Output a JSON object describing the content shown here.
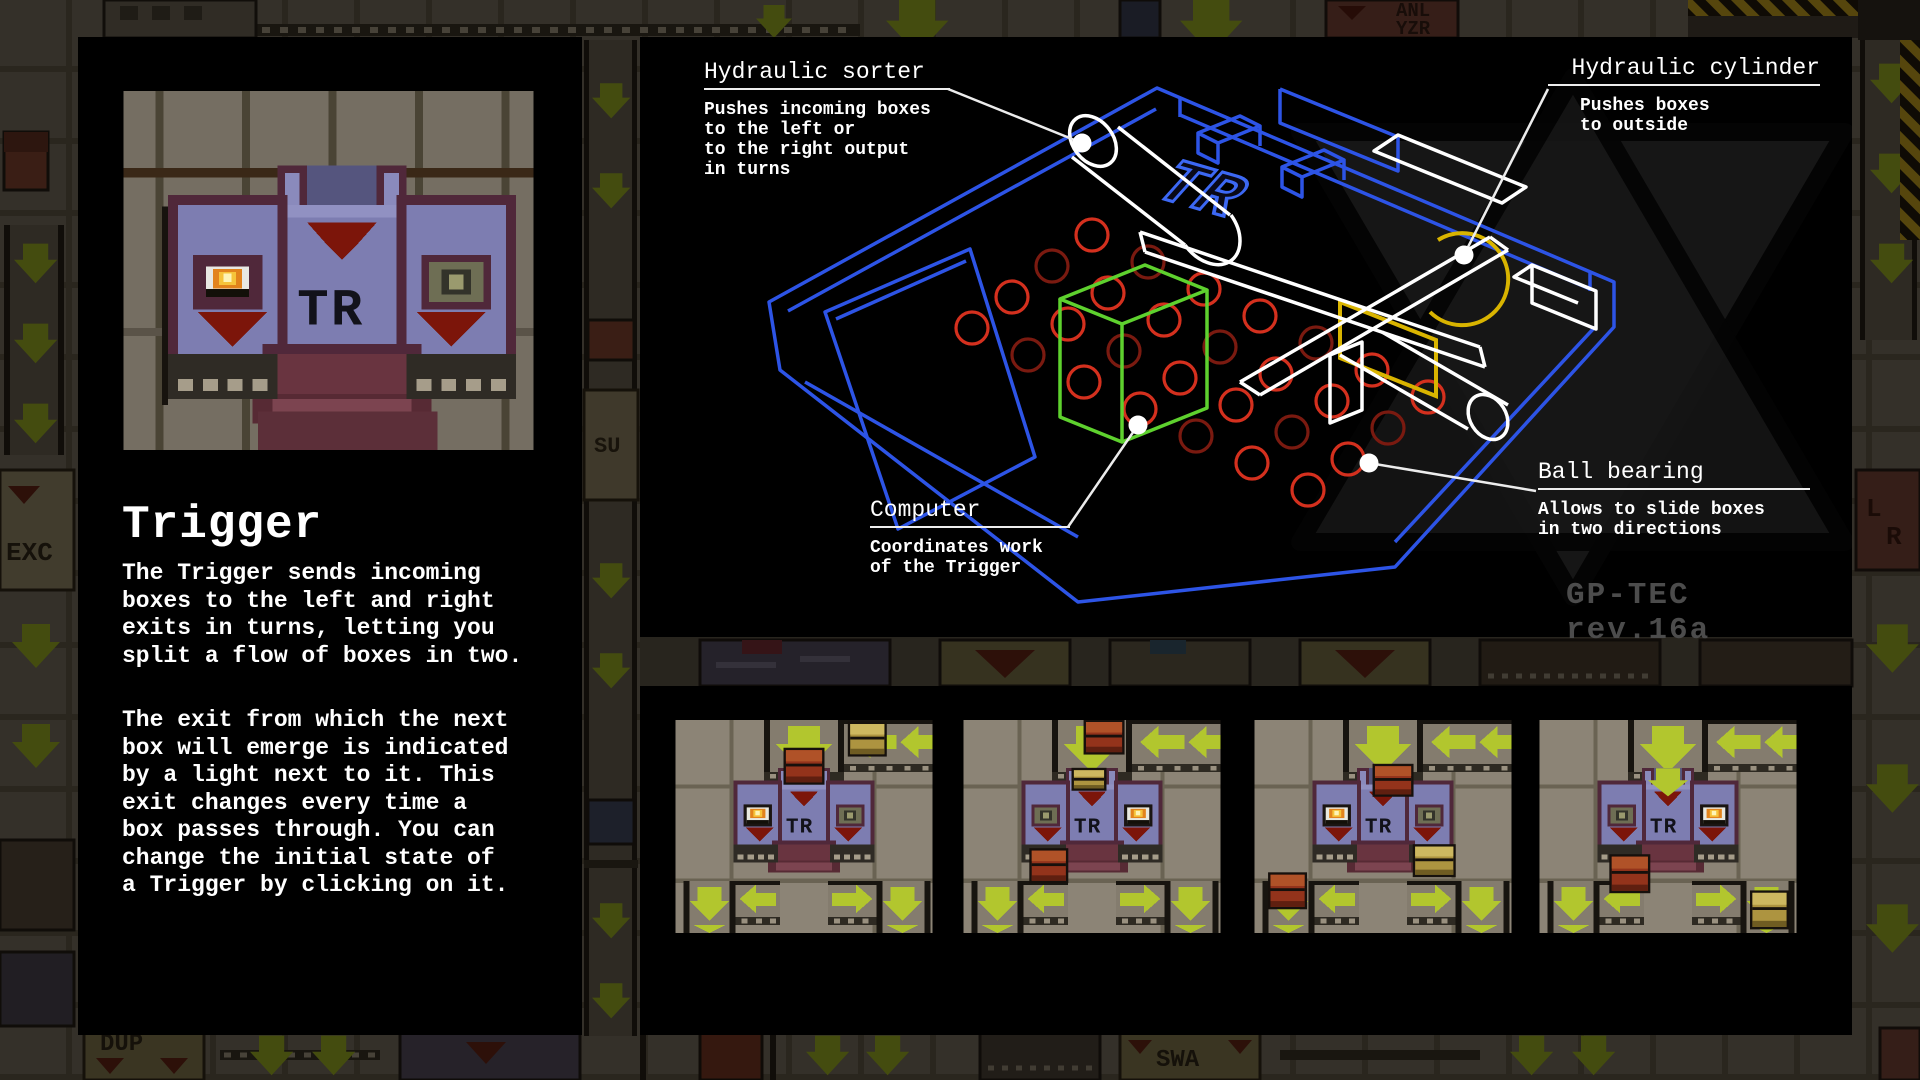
{
  "panel_left": {
    "title": "Trigger",
    "machine_label": "TR",
    "paragraph1": "The Trigger sends incoming\nboxes to the left and right\nexits in turns, letting you\nsplit a flow of boxes in two.",
    "paragraph2": "The exit from which the next\nbox will emerge is indicated\nby a light next to it. This\nexit changes every time a\nbox passes through. You can\nchange the initial state of\na Trigger by clicking on it."
  },
  "diagram": {
    "machine_emblem": "TR",
    "watermark_text": "GP-TEC rev.16a",
    "callouts": {
      "sorter": {
        "title": "Hydraulic sorter",
        "desc": "Pushes incoming boxes\nto the left or\nto the right output\nin turns"
      },
      "cylinder": {
        "title": "Hydraulic cylinder",
        "desc": "Pushes boxes\nto outside"
      },
      "computer": {
        "title": "Computer",
        "desc": "Coordinates work\nof the Trigger"
      },
      "bearing": {
        "title": "Ball bearing",
        "desc": "Allows to slide boxes\nin two directions"
      }
    },
    "colors": {
      "wireframe_blue": "#2d54e6",
      "computer_green": "#5ed12e",
      "bearing_red": "#d4301e",
      "cylinder_yellow": "#d9b400",
      "callout_white": "#ffffff"
    }
  },
  "screenshots": [
    {
      "lamp_lit": "left",
      "intake_arrow": false,
      "boxes": [
        {
          "color": "red",
          "x": 55,
          "y": 15,
          "w": 18,
          "h": 16
        },
        {
          "color": "yellow",
          "x": 87,
          "y": 2,
          "w": 17,
          "h": 15
        }
      ]
    },
    {
      "lamp_lit": "right",
      "intake_arrow": false,
      "boxes": [
        {
          "color": "yellow",
          "x": 55,
          "y": 25,
          "w": 15,
          "h": 9
        },
        {
          "color": "red",
          "x": 61,
          "y": 1,
          "w": 18,
          "h": 15
        },
        {
          "color": "red",
          "x": 34,
          "y": 65,
          "w": 17,
          "h": 15
        }
      ]
    },
    {
      "lamp_lit": "left",
      "intake_arrow": false,
      "boxes": [
        {
          "color": "red",
          "x": 60,
          "y": 23,
          "w": 18,
          "h": 14
        },
        {
          "color": "yellow",
          "x": 80,
          "y": 63,
          "w": 19,
          "h": 14
        },
        {
          "color": "red",
          "x": 8,
          "y": 77,
          "w": 17,
          "h": 16
        }
      ]
    },
    {
      "lamp_lit": "right",
      "intake_arrow": true,
      "boxes": [
        {
          "color": "red",
          "x": 36,
          "y": 68,
          "w": 18,
          "h": 17
        },
        {
          "color": "yellow",
          "x": 106,
          "y": 86,
          "w": 17,
          "h": 17
        }
      ]
    }
  ],
  "scene_colors": {
    "arrow_green": "#b2c62e",
    "red_box": {
      "outline": "#16100c",
      "body": "#93331b",
      "light": "#b05228",
      "dark": "#5f1f10"
    },
    "yellow_box": {
      "outline": "#16110c",
      "body": "#ad9440",
      "light": "#cdb860",
      "dark": "#6f5c22"
    },
    "lamp_flame": {
      "outer": "#e2831c",
      "mid": "#f6c33a",
      "core": "#fdf4b6"
    }
  },
  "background": {
    "labels": {
      "exc": "EXC",
      "su": "SU",
      "anl": "ANL",
      "yzr": "YZR",
      "l": "L",
      "r": "R",
      "dup": "DUP",
      "swa": "SWA"
    }
  }
}
